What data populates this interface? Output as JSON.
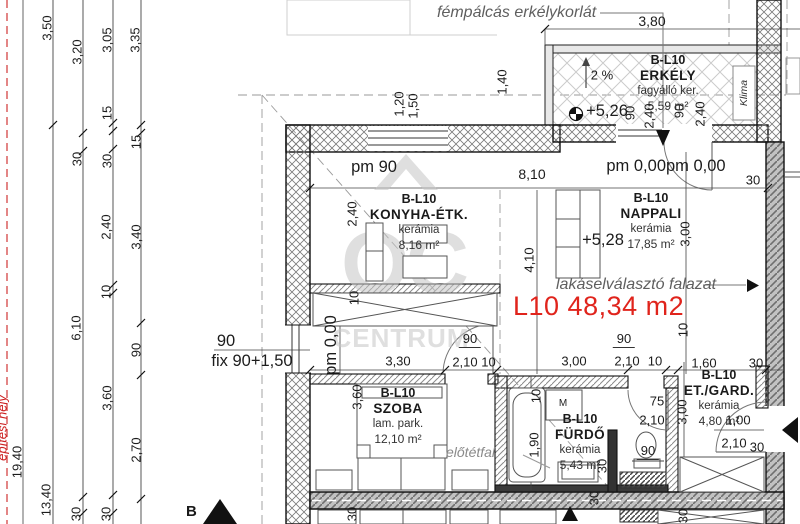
{
  "colors": {
    "red_accent": "#e0241c",
    "line": "#1a1a1a",
    "gray_text": "#5f5f5f",
    "watermark": "#c5c5c5",
    "site_red": "#cc2222"
  },
  "watermark": {
    "oc": "OC",
    "line1": "OTTHON",
    "line2": "CENTRUM"
  },
  "callouts": {
    "railing": "fémpálcás erkélykorlát",
    "divider": "lakáselválasztó falazat",
    "furring": "előtétfal",
    "total_area": "L10 48,34 m2",
    "klima": "Klima",
    "site": "építési hely",
    "section": "B"
  },
  "rooms": [
    {
      "id": "erkely",
      "code": "B-L10",
      "name": "ERKÉLY",
      "material": "fagyálló ker.",
      "area": "5,59 m²",
      "x": 668,
      "y": 53
    },
    {
      "id": "konyha",
      "code": "B-L10",
      "name": "KONYHA-ÉTK.",
      "material": "kerámia",
      "area": "8,16 m²",
      "x": 419,
      "y": 192
    },
    {
      "id": "nappali",
      "code": "B-L10",
      "name": "NAPPALI",
      "material": "kerámia",
      "area": "17,85 m²",
      "x": 651,
      "y": 191
    },
    {
      "id": "szoba",
      "code": "B-L10",
      "name": "SZOBA",
      "material": "lam. park.",
      "area": "12,10 m²",
      "x": 398,
      "y": 386
    },
    {
      "id": "furdo",
      "code": "B-L10",
      "name": "FÜRDŐ",
      "material": "kerámia",
      "area": "5,43 m²",
      "x": 580,
      "y": 412
    },
    {
      "id": "gard",
      "code": "B-L10",
      "name": "ET./GARD.",
      "material": "kerámia",
      "area": "4,80 m²",
      "x": 719,
      "y": 368
    }
  ],
  "dims": [
    {
      "t": "3,50",
      "x": 47,
      "y": 28,
      "r": 1
    },
    {
      "t": "3,20",
      "x": 77,
      "y": 52,
      "r": 1
    },
    {
      "t": "3,05",
      "x": 107,
      "y": 40,
      "r": 1
    },
    {
      "t": "3,35",
      "x": 135,
      "y": 40,
      "r": 1
    },
    {
      "t": "15",
      "x": 107,
      "y": 113,
      "r": 1
    },
    {
      "t": "15",
      "x": 136,
      "y": 142,
      "r": 1
    },
    {
      "t": "30",
      "x": 77,
      "y": 159,
      "r": 1
    },
    {
      "t": "30",
      "x": 107,
      "y": 161,
      "r": 1
    },
    {
      "t": "2,40",
      "x": 106,
      "y": 227,
      "r": 1
    },
    {
      "t": "3,40",
      "x": 136,
      "y": 237,
      "r": 1
    },
    {
      "t": "10",
      "x": 106,
      "y": 292,
      "r": 1
    },
    {
      "t": "6,10",
      "x": 76,
      "y": 328,
      "r": 1
    },
    {
      "t": "90",
      "x": 136,
      "y": 350,
      "r": 1
    },
    {
      "t": "3,60",
      "x": 107,
      "y": 398,
      "r": 1
    },
    {
      "t": "2,70",
      "x": 136,
      "y": 450,
      "r": 1
    },
    {
      "t": "19,40",
      "x": 17,
      "y": 462,
      "r": 1
    },
    {
      "t": "13,40",
      "x": 46,
      "y": 500,
      "r": 1
    },
    {
      "t": "30",
      "x": 76,
      "y": 514,
      "r": 1
    },
    {
      "t": "30",
      "x": 106,
      "y": 514,
      "r": 1
    },
    {
      "t": "3,80",
      "x": 652,
      "y": 21,
      "c": "x14"
    },
    {
      "t": "2 %",
      "x": 602,
      "y": 75
    },
    {
      "t": "1,40",
      "x": 502,
      "y": 82,
      "r": 1
    },
    {
      "t": "1,20",
      "x": 399,
      "y": 104,
      "r": 1
    },
    {
      "t": "1,50",
      "x": 413,
      "y": 106,
      "r": 1
    },
    {
      "t": "90",
      "x": 630,
      "y": 113,
      "r": 1
    },
    {
      "t": "2,40",
      "x": 649,
      "y": 116,
      "r": 1
    },
    {
      "t": "90",
      "x": 679,
      "y": 111,
      "r": 1
    },
    {
      "t": "2,40",
      "x": 700,
      "y": 114,
      "r": 1
    },
    {
      "t": "+5,26",
      "x": 607,
      "y": 111,
      "c": "lg"
    },
    {
      "t": "pm 0,00pm 0,00",
      "x": 666,
      "y": 166,
      "c": "lg"
    },
    {
      "t": "30",
      "x": 753,
      "y": 180
    },
    {
      "t": "pm 90",
      "x": 374,
      "y": 167,
      "c": "lg"
    },
    {
      "t": "8,10",
      "x": 532,
      "y": 174,
      "c": "x14"
    },
    {
      "t": "2,40",
      "x": 352,
      "y": 214,
      "r": 1
    },
    {
      "t": "+5,28",
      "x": 603,
      "y": 240,
      "c": "lg"
    },
    {
      "t": "3,00",
      "x": 685,
      "y": 234,
      "r": 1
    },
    {
      "t": "4,10",
      "x": 529,
      "y": 260,
      "r": 1
    },
    {
      "t": "10",
      "x": 354,
      "y": 298,
      "r": 1
    },
    {
      "t": "pm 0,00",
      "x": 331,
      "y": 345,
      "r": 1,
      "c": "lg"
    },
    {
      "t": "90",
      "x": 226,
      "y": 341,
      "c": "lg"
    },
    {
      "t": "fix 90+1,50",
      "x": 252,
      "y": 361,
      "c": "lg"
    },
    {
      "t": "3,30",
      "x": 398,
      "y": 361
    },
    {
      "t": "90",
      "x": 470,
      "y": 340,
      "c": "us"
    },
    {
      "t": "2,10 10",
      "x": 474,
      "y": 362
    },
    {
      "t": "3,00",
      "x": 574,
      "y": 361
    },
    {
      "t": "90",
      "x": 624,
      "y": 340,
      "c": "us"
    },
    {
      "t": "2,10",
      "x": 627,
      "y": 361
    },
    {
      "t": "10",
      "x": 655,
      "y": 361
    },
    {
      "t": "1,60",
      "x": 704,
      "y": 363
    },
    {
      "t": "30",
      "x": 756,
      "y": 363
    },
    {
      "t": "10",
      "x": 683,
      "y": 330,
      "r": 1
    },
    {
      "t": "3,60",
      "x": 357,
      "y": 397,
      "r": 1
    },
    {
      "t": "10",
      "x": 536,
      "y": 396,
      "r": 1
    },
    {
      "t": "1,90",
      "x": 534,
      "y": 445,
      "r": 1
    },
    {
      "t": "M",
      "x": 563,
      "y": 404,
      "c": "sm"
    },
    {
      "t": "75",
      "x": 657,
      "y": 401
    },
    {
      "t": "2,10",
      "x": 652,
      "y": 420
    },
    {
      "t": "3,00",
      "x": 682,
      "y": 412,
      "r": 1
    },
    {
      "t": "90",
      "x": 648,
      "y": 452,
      "c": "us"
    },
    {
      "t": "30",
      "x": 602,
      "y": 466,
      "r": 1
    },
    {
      "t": "30",
      "x": 594,
      "y": 498,
      "r": 1
    },
    {
      "t": "1,00",
      "x": 738,
      "y": 420
    },
    {
      "t": "2,10",
      "x": 734,
      "y": 443
    },
    {
      "t": "30",
      "x": 757,
      "y": 447
    },
    {
      "t": "30",
      "x": 352,
      "y": 514,
      "r": 1
    },
    {
      "t": "30",
      "x": 683,
      "y": 516,
      "r": 1
    }
  ]
}
